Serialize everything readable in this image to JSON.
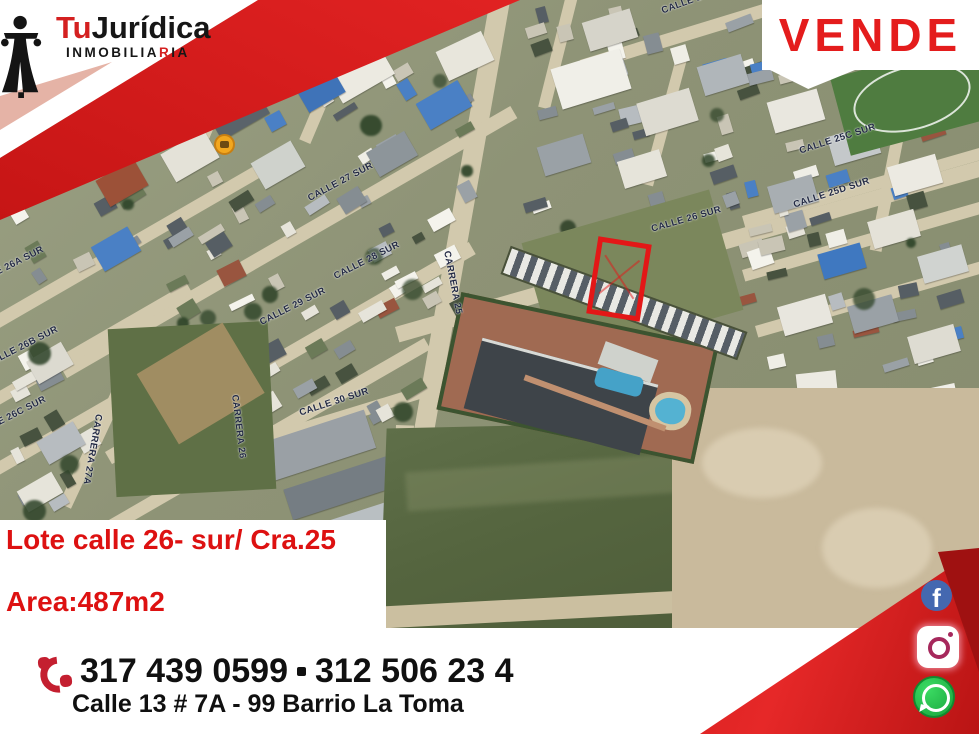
{
  "brand": {
    "name_prefix": "Tu",
    "name_suffix": "Jurídica",
    "subtitle_pre": "INMOBILIA",
    "subtitle_accent": "R",
    "subtitle_post": "IA"
  },
  "banner": {
    "vende": "VENDE"
  },
  "listing": {
    "title": "Lote calle 26- sur/ Cra.25",
    "area": "Area:487m2"
  },
  "contact": {
    "phone1": "317 439 0599",
    "phone2": "312 506 23 4",
    "address": "Calle 13 # 7A - 99 Barrio La Toma"
  },
  "social": {
    "facebook_letter": "f"
  },
  "colors": {
    "accent_red": "#e41c1c",
    "ribbon_red": "#d42020",
    "dark_red": "#9f1111",
    "facebook_blue": "#4468b0",
    "instagram_pink": "#a6285c",
    "whatsapp_green": "#17a33b",
    "marker_yellow": "#f2a71f",
    "street_label_navy": "#232a44",
    "lot_outline_red": "#e31717"
  },
  "map": {
    "street_labels": [
      {
        "text": "CALLE 25B SUR",
        "x": 660,
        "y": 6,
        "rot": -20
      },
      {
        "text": "CALLE 25C SUR",
        "x": 798,
        "y": 146,
        "rot": -18
      },
      {
        "text": "CALLE 25D SUR",
        "x": 792,
        "y": 200,
        "rot": -18
      },
      {
        "text": "CALLE 26 SUR",
        "x": 650,
        "y": 224,
        "rot": -16
      },
      {
        "text": "CALLE 27 SUR",
        "x": 306,
        "y": 194,
        "rot": -28
      },
      {
        "text": "CALLE 28 SUR",
        "x": 332,
        "y": 272,
        "rot": -27
      },
      {
        "text": "CALLE 29 SUR",
        "x": 258,
        "y": 318,
        "rot": -27
      },
      {
        "text": "CALLE 30 SUR",
        "x": 298,
        "y": 408,
        "rot": -18
      },
      {
        "text": "CALLE 26A SUR",
        "x": -30,
        "y": 280,
        "rot": -27
      },
      {
        "text": "CALLE 26B SUR",
        "x": -16,
        "y": 360,
        "rot": -27
      },
      {
        "text": "CALLE 26C SUR",
        "x": -28,
        "y": 430,
        "rot": -27
      },
      {
        "text": "CARRERA 27A",
        "x": 104,
        "y": 415,
        "rot": 100
      },
      {
        "text": "CARRERA 25",
        "x": 452,
        "y": 250,
        "rot": 79
      },
      {
        "text": "CARRERA 26",
        "x": 240,
        "y": 394,
        "rot": 83
      }
    ]
  }
}
